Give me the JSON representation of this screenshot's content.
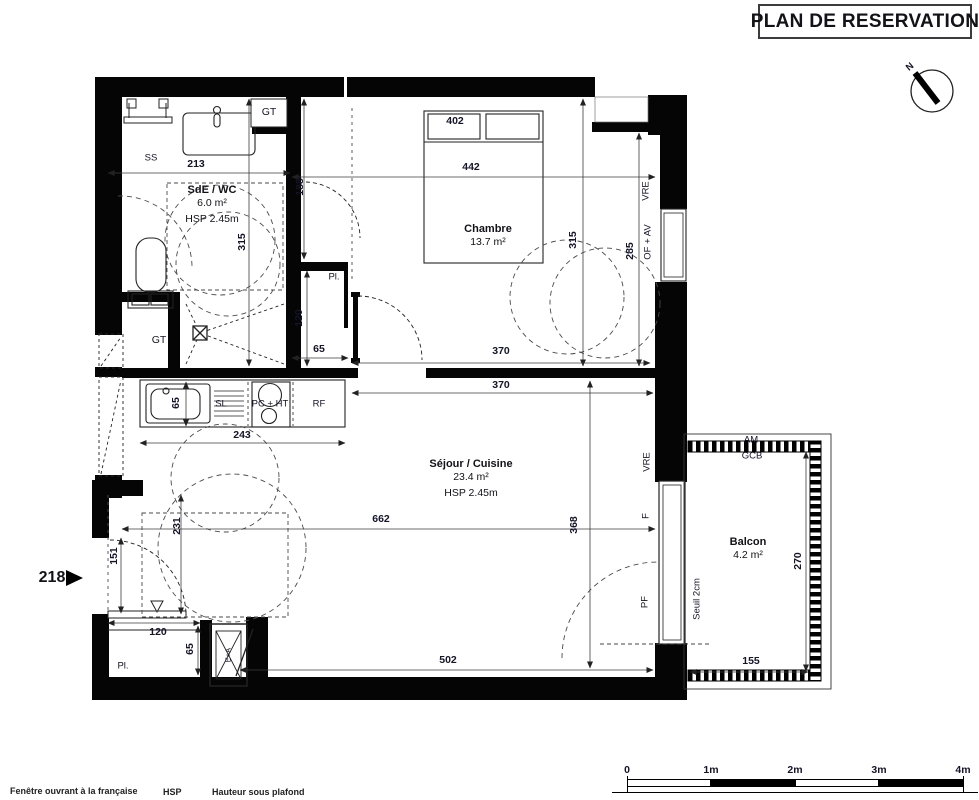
{
  "title": "PLAN DE RESERVATION",
  "unit": {
    "number": "218"
  },
  "rooms": [
    {
      "id": "sde",
      "name": "SdE / WC",
      "area": "6.0 m²",
      "hsp": "HSP 2.45m",
      "x": 212,
      "y": 184
    },
    {
      "id": "chambre",
      "name": "Chambre",
      "area": "13.7 m²",
      "hsp": "",
      "x": 488,
      "y": 223
    },
    {
      "id": "sejour",
      "name": "Séjour / Cuisine",
      "area": "23.4 m²",
      "hsp": "HSP 2.45m",
      "x": 471,
      "y": 458
    },
    {
      "id": "balcon",
      "name": "Balcon",
      "area": "4.2 m²",
      "hsp": "",
      "x": 748,
      "y": 536
    }
  ],
  "dimensions": [
    {
      "text": "213",
      "x": 196,
      "y": 164,
      "rot": 0
    },
    {
      "text": "442",
      "x": 471,
      "y": 167,
      "rot": 0
    },
    {
      "text": "188",
      "x": 300,
      "y": 187,
      "rot": -90
    },
    {
      "text": "315",
      "x": 242,
      "y": 242,
      "rot": -90
    },
    {
      "text": "315",
      "x": 573,
      "y": 240,
      "rot": -90
    },
    {
      "text": "285",
      "x": 630,
      "y": 251,
      "rot": -90
    },
    {
      "text": "120",
      "x": 299,
      "y": 318,
      "rot": -90
    },
    {
      "text": "65",
      "x": 319,
      "y": 349,
      "rot": 0
    },
    {
      "text": "370",
      "x": 501,
      "y": 351,
      "rot": 0
    },
    {
      "text": "370",
      "x": 501,
      "y": 385,
      "rot": 0
    },
    {
      "text": "65",
      "x": 176,
      "y": 403,
      "rot": -90
    },
    {
      "text": "243",
      "x": 242,
      "y": 435,
      "rot": 0
    },
    {
      "text": "662",
      "x": 381,
      "y": 519,
      "rot": 0
    },
    {
      "text": "368",
      "x": 574,
      "y": 525,
      "rot": -90
    },
    {
      "text": "231",
      "x": 177,
      "y": 526,
      "rot": -90
    },
    {
      "text": "151",
      "x": 114,
      "y": 556,
      "rot": -90
    },
    {
      "text": "120",
      "x": 158,
      "y": 632,
      "rot": 0
    },
    {
      "text": "65",
      "x": 190,
      "y": 649,
      "rot": -90
    },
    {
      "text": "502",
      "x": 448,
      "y": 660,
      "rot": 0
    },
    {
      "text": "270",
      "x": 798,
      "y": 561,
      "rot": -90
    },
    {
      "text": "155",
      "x": 751,
      "y": 661,
      "rot": 0
    }
  ],
  "annotations": [
    {
      "text": "402",
      "x": 455,
      "y": 121,
      "rot": 0,
      "bold": true,
      "fs": 10.5
    },
    {
      "text": "SS",
      "x": 151,
      "y": 158,
      "rot": 0
    },
    {
      "text": "GT",
      "x": 269,
      "y": 112,
      "rot": 0,
      "fs": 10.5
    },
    {
      "text": "GT",
      "x": 159,
      "y": 340,
      "rot": 0,
      "fs": 10.5
    },
    {
      "text": "Pl.",
      "x": 334,
      "y": 277,
      "rot": 0
    },
    {
      "text": "Pl.",
      "x": 123,
      "y": 666,
      "rot": 0
    },
    {
      "text": "SL",
      "x": 221,
      "y": 404,
      "rot": 0
    },
    {
      "text": "PC + HT",
      "x": 270,
      "y": 404,
      "rot": 0
    },
    {
      "text": "RF",
      "x": 319,
      "y": 404,
      "rot": 0
    },
    {
      "text": "VRE",
      "x": 646,
      "y": 191,
      "rot": -90
    },
    {
      "text": "OF + AV",
      "x": 648,
      "y": 242,
      "rot": -90
    },
    {
      "text": "VRE",
      "x": 647,
      "y": 462,
      "rot": -90
    },
    {
      "text": "F",
      "x": 646,
      "y": 516,
      "rot": -90
    },
    {
      "text": "PF",
      "x": 645,
      "y": 602,
      "rot": -90
    },
    {
      "text": "Seuil 2cm",
      "x": 697,
      "y": 599,
      "rot": -90
    },
    {
      "text": "AM",
      "x": 751,
      "y": 440,
      "rot": 0
    },
    {
      "text": "GCB",
      "x": 752,
      "y": 456,
      "rot": 0
    },
    {
      "text": "E+A",
      "x": 228,
      "y": 655,
      "rot": -90,
      "fs": 7.5
    },
    {
      "text": "N",
      "x": 910,
      "y": 67,
      "rot": -40,
      "bold": true,
      "fs": 9.5
    }
  ],
  "scale": {
    "labels": [
      "0",
      "1m",
      "2m",
      "3m",
      "4m"
    ]
  },
  "legend": {
    "window_label": "Fenêtre ouvrant à la française",
    "hsp_abbr": "HSP",
    "hsp_label": "Hauteur sous plafond"
  }
}
